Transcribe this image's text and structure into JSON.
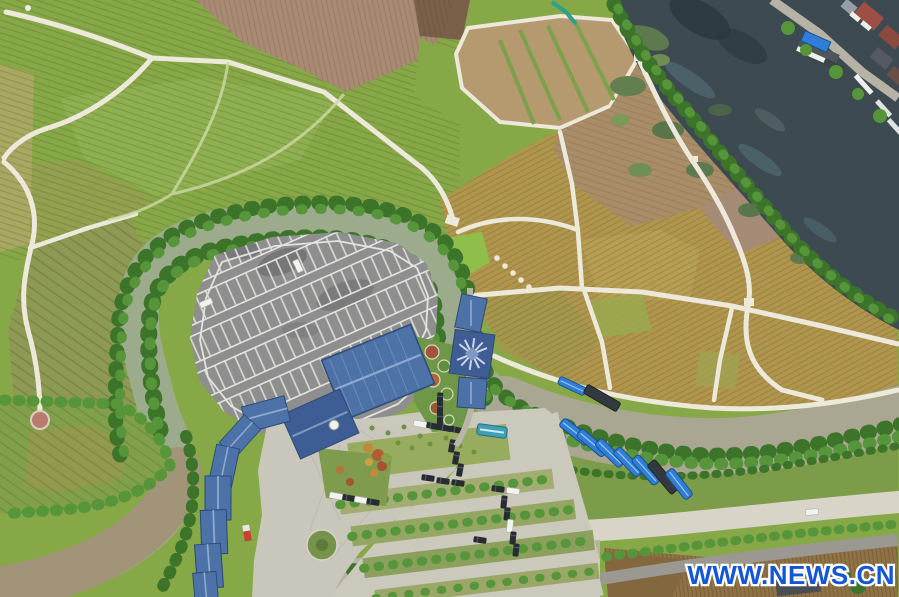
{
  "meta": {
    "type": "aerial-photograph",
    "width_px": 899,
    "height_px": 597
  },
  "watermark": {
    "text": "WWW.NEWS.CN"
  },
  "palette": {
    "greenBase": "#86a847",
    "greenLight": "#8fb051",
    "greenDark": "#6d9a3c",
    "olivePale": "#a8a862",
    "terrace": "#8e9a54",
    "brownPink": "#a98a74",
    "brownDark": "#7a5f49",
    "tan": "#b49a6e",
    "tanDark": "#a88d68",
    "gold": "#b0954d",
    "goldLight": "#b8a055",
    "goldOlive": "#a3964b",
    "path": "#ece9da",
    "river": "#9cab8c",
    "riverGray": "#a9a691",
    "riverBrown": "#a29478",
    "lake": "#3d4a52",
    "treeDark": "#3c7429",
    "tree": "#56953a",
    "asphalt": "#8e8e8e",
    "line": "#e2e2de",
    "roofBlue": "#4d72a8",
    "roofBlueDark": "#3e5d94",
    "concrete": "#cbc8bc",
    "plaza": "#c9c6bb",
    "gravel": "#9a9890",
    "carDark": "#272c33",
    "white": "#f2f2ee",
    "boatBlue": "#2f7fd8",
    "busTeal": "#3e9fb5",
    "red": "#c8402f",
    "soil": "#8f7347",
    "villageRed": "#9c4f43",
    "watermark": "#1456d8"
  },
  "scene": {
    "description": "Drone top-down view of countryside: terraced green paddies (NW), tilled brown fields (N), golden harvested paddies divided by white footpaths (E), a dark weedy pond with a lakeside village and docks (NE corner), an oxbow river looping around a large car park with blue-roofed visitor buildings, a covered bridge with a star-patterned pavilion roof, landscaped gardens with rows of parked cars and a teal bus (S), blue-canopied boats moored along the river, and concrete riverside roads (SE).",
    "objects": [
      "terraced-fields",
      "tilled-fields",
      "golden-paddies",
      "white-footpaths",
      "dark-pond",
      "village-docks-boats",
      "oxbow-river",
      "riverside-trees",
      "car-park",
      "parking-stall-markings",
      "blue-roof-buildings",
      "covered-bridge",
      "garden-beds",
      "parked-cars",
      "teal-bus",
      "moored-boats",
      "concrete-roads",
      "watermark"
    ]
  }
}
